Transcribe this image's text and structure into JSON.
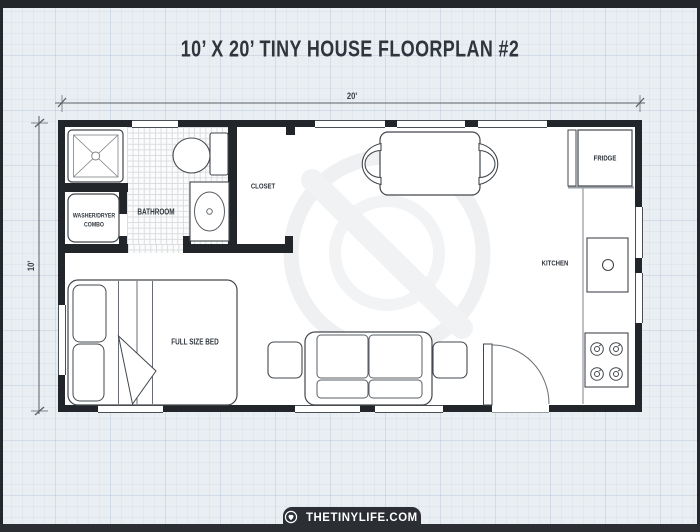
{
  "title": "10’ X 20’ TINY HOUSE FLOORPLAN #2",
  "dimensions": {
    "width": "20'",
    "depth": "10'"
  },
  "labels": {
    "bathroom": "BATHROOM",
    "closet": "CLOSET",
    "kitchen": "KITCHEN",
    "fridge": "FRIDGE",
    "washer_line1": "WASHER/DRYER",
    "washer_line2": "COMBO",
    "bed": "FULL SIZE BED"
  },
  "footer": {
    "site": "THETINYLIFE.COM"
  },
  "colors": {
    "background": "#e9eef2",
    "grid_line": "#c7d5e0",
    "wall": "#22262b",
    "room": "#ffffff",
    "ink": "#2f353c",
    "frame_bar": "#2b2f34",
    "watermark": "#eef0f2"
  }
}
